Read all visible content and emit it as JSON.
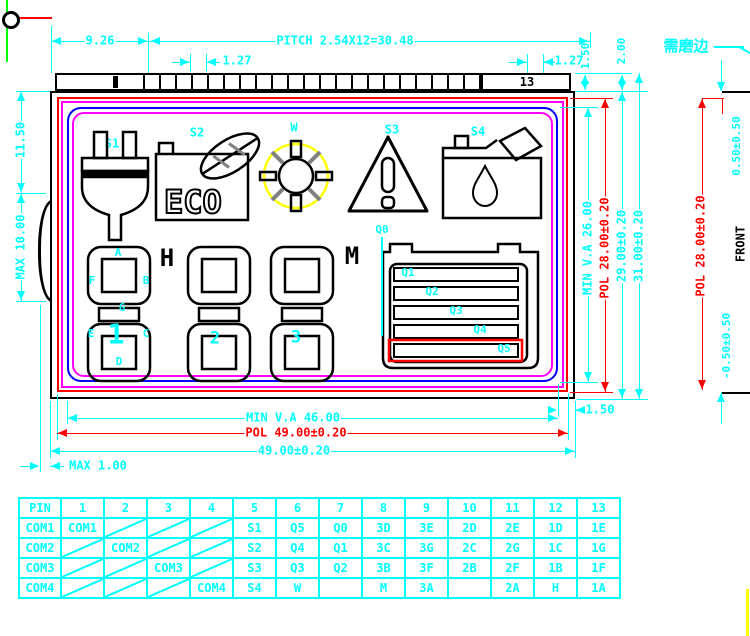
{
  "colors": {
    "dim_cyan": "#00ffff",
    "pol_red": "#ff0000",
    "seal_magenta": "#ff00ff",
    "viewing_area_blue": "#0000ff",
    "sun_yellow": "#ffff00",
    "axis_green": "#00ff00",
    "line_black": "#000000",
    "hatch_gray": "#808080"
  },
  "dims": {
    "d926": "9.26",
    "pitch": "PITCH 2.54X12=30.48",
    "p127l": "1.27",
    "p127r": "1.27",
    "s150": "1.50",
    "s200": "2.00",
    "l1150": "11.50",
    "lmax10": "MAX 10.00",
    "bva": "MIN V.A 46.00",
    "bpol": "POL 49.00±0.20",
    "bglass": "49.00±0.20",
    "bmax1": "MAX 1.00",
    "bgap": "1.50",
    "rva": "MIN V.A 26.00",
    "rpol": "POL 28.00±0.20",
    "rglass": "29.00±0.20",
    "rtotal": "31.00±0.20"
  },
  "strip": {
    "pin13": "13"
  },
  "lcd": {
    "s1": "S1",
    "s2": "S2",
    "w": "W",
    "s3": "S3",
    "s4": "S4",
    "eco": "ECO",
    "segA": "A",
    "segF": "F",
    "segB": "B",
    "segG": "G",
    "segE": "E",
    "segC": "C",
    "segD": "D",
    "digit1": "1",
    "digit2": "2",
    "digit3": "3",
    "letterH": "H",
    "letterM": "M",
    "q0": "Q0",
    "q1": "Q1",
    "q2": "Q2",
    "q3": "Q3",
    "q4": "Q4",
    "q5": "Q5"
  },
  "side": {
    "note": "需磨边",
    "front": "FRONT",
    "top": "0.50±0.50",
    "pol": "POL 28.00±0.20",
    "bottom": "-0.50±0.50"
  },
  "table": {
    "header": [
      "PIN",
      "1",
      "2",
      "3",
      "4",
      "5",
      "6",
      "7",
      "8",
      "9",
      "10",
      "11",
      "12",
      "13"
    ],
    "rows": [
      {
        "label": "COM1",
        "color": "#ff0000",
        "cells": [
          "COM1",
          "",
          "",
          "",
          "S1",
          "Q5",
          "Q0",
          "3D",
          "3E",
          "2D",
          "2E",
          "1D",
          "1E"
        ]
      },
      {
        "label": "COM2",
        "color": "#ffff00",
        "cells": [
          "",
          "COM2",
          "",
          "",
          "S2",
          "Q4",
          "Q1",
          "3C",
          "3G",
          "2C",
          "2G",
          "1C",
          "1G"
        ]
      },
      {
        "label": "COM3",
        "color": "#00ffff",
        "cells": [
          "",
          "",
          "COM3",
          "",
          "S3",
          "Q3",
          "Q2",
          "3B",
          "3F",
          "2B",
          "2F",
          "1B",
          "1F"
        ]
      },
      {
        "label": "COM4",
        "color": "#ff00ff",
        "cells": [
          "",
          "",
          "",
          "COM4",
          "S4",
          "W",
          "",
          "M",
          "3A",
          "",
          "2A",
          "H",
          "1A"
        ]
      }
    ]
  }
}
